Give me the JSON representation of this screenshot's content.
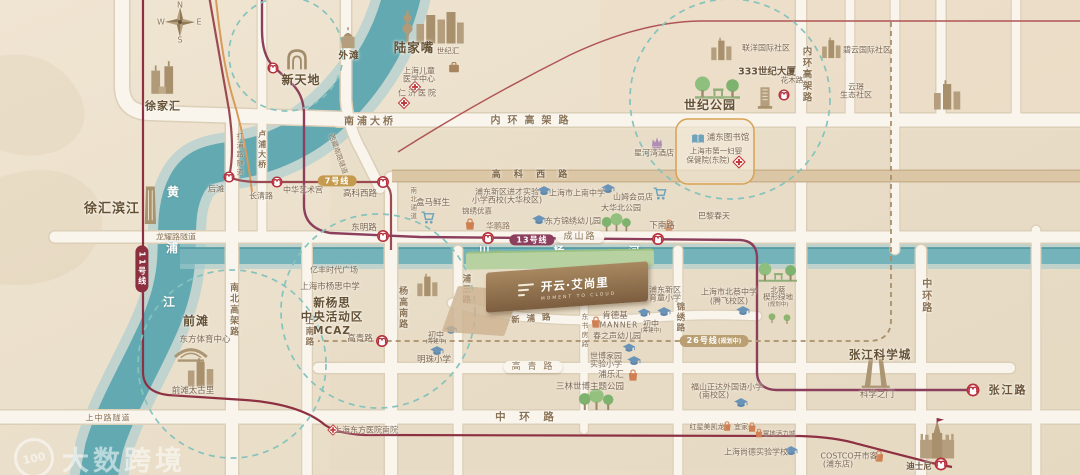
{
  "watermark": {
    "brand": "大数跨境",
    "badge": "100"
  },
  "compass": {
    "n": "N",
    "s": "S",
    "e": "E",
    "w": "W"
  },
  "project": {
    "name": "开云·艾尚里",
    "tagline": "MOMENT TO CLOUD"
  },
  "rivers": {
    "huangpu": [
      "黄",
      "浦",
      "江"
    ],
    "chuanyang": "川 杨 河"
  },
  "areas": {
    "xujiahui": "徐家汇",
    "xintiandi": "新天地",
    "waitan": "外滩",
    "lujiazui": "陆家嘴",
    "shijihui": "世纪汇",
    "century_park": "世纪公园",
    "qiantan": "前滩",
    "xuhui_riverside": "徐汇滨江",
    "zhangjiang": "张江科学城",
    "mcaz1": "新杨思",
    "mcaz2": "中央活动区",
    "mcaz3": "MCAZ"
  },
  "roads": {
    "nanpu_bridge": "南浦大桥",
    "inner_ring_h": "内环高架路",
    "inner_ring_v": "内环高架路",
    "gaoke_west": "高 科 西 路",
    "chengshan": "成山路",
    "longyao_tunnel": "龙耀路隧道",
    "shangzhong_tunnel": "上中路隧道",
    "mid_ring_h": "中 环 路",
    "mid_ring_v": "中环路",
    "gaoqing": "高 青 路",
    "xinpu": "新 浦 路",
    "nanbei_elevated": "南北高架路",
    "shangnan": "上南路",
    "yanggao_south": "杨高南路",
    "nanbei_passage": "南北通道",
    "pusan": "浦三路",
    "dongshufang": "东书房路",
    "jinxiu": "锦绣路",
    "dapu_tunnel": "打浦路隧道",
    "lupu_bridge": "卢浦大桥",
    "xizang_tunnel": "西藏南路隧道",
    "huapeng": "华鹏路"
  },
  "lines": {
    "l7": "7号线",
    "l13": "13号线",
    "l11": "11号线",
    "l26": "26号线",
    "planned": "(规划中)"
  },
  "stations": {
    "houtan": "后滩",
    "changqing": "长清路",
    "art_palace": "中华艺术宫",
    "gaokexi": "高科西路",
    "dongming": "东明路",
    "xianan": "下南路",
    "gaoqing": "高青路",
    "huamu": "花木路",
    "zhangjiang": "张江路",
    "disney": "迪士尼"
  },
  "pois": {
    "children_hospital": [
      "上海儿童",
      "医学中心"
    ],
    "renji": "仁济医院",
    "first_maternity": [
      "上海市第一妇婴",
      "保健院(东院)"
    ],
    "dongfang_hospital": "上海东方医院南院",
    "hema": "盒马鲜生",
    "sams": "山姆会员店",
    "printemps": "巴黎春天",
    "jinxiu_youjia": "锦绣优嘉",
    "yifeng": "亿丰时代广场",
    "kfc": "肯德基",
    "manner": "MANNER",
    "pulehui": "浦乐汇",
    "taikoo": "前滩太古里",
    "macalline": "红星美凯龙",
    "ikea": "宜家",
    "yidi": "翼地活力城",
    "costco": [
      "COSTCO开市客",
      "(浦东店)"
    ],
    "library": "浦东图书馆",
    "xinghewan": "星河湾酒店",
    "jincai": [
      "浦东新区进才实验",
      "小学西校(大华校区)"
    ],
    "shangnan_ms": "上海市上南中学",
    "dongfang_kg": "东方锦绣幼儿园",
    "mingzhu": "明珠小学",
    "junior1": "初中",
    "junior1_note": "(筹建中)",
    "junior2": "初中",
    "junior2_note": "(筹建中)",
    "yutong": [
      "浦东新区",
      "育童小学"
    ],
    "chunzhisheng": "春之声幼儿园",
    "expo_primary": [
      "世博家园",
      "实验小学"
    ],
    "fushan": [
      "福山正达外国语小学",
      "(南校区)"
    ],
    "shangde": "上海尚德实验学校",
    "beicai_ms": [
      "上海市北蔡中学",
      "(腾飞校区)"
    ],
    "yangsi_ms": "上海市杨思中学",
    "dahua_park": "大华北公园",
    "beicai_green": [
      "北蔡",
      "楔形绿地",
      "(规划中)"
    ],
    "sanlin_park": "三林世博主题公园",
    "oriental_sports": "东方体育中心",
    "science_gate": "科学之门",
    "lianyang": "联洋国际社区",
    "biyun": "碧云国际社区",
    "yunjing": [
      "云璟",
      "生态社区"
    ],
    "tower333": "333世纪大厦"
  }
}
